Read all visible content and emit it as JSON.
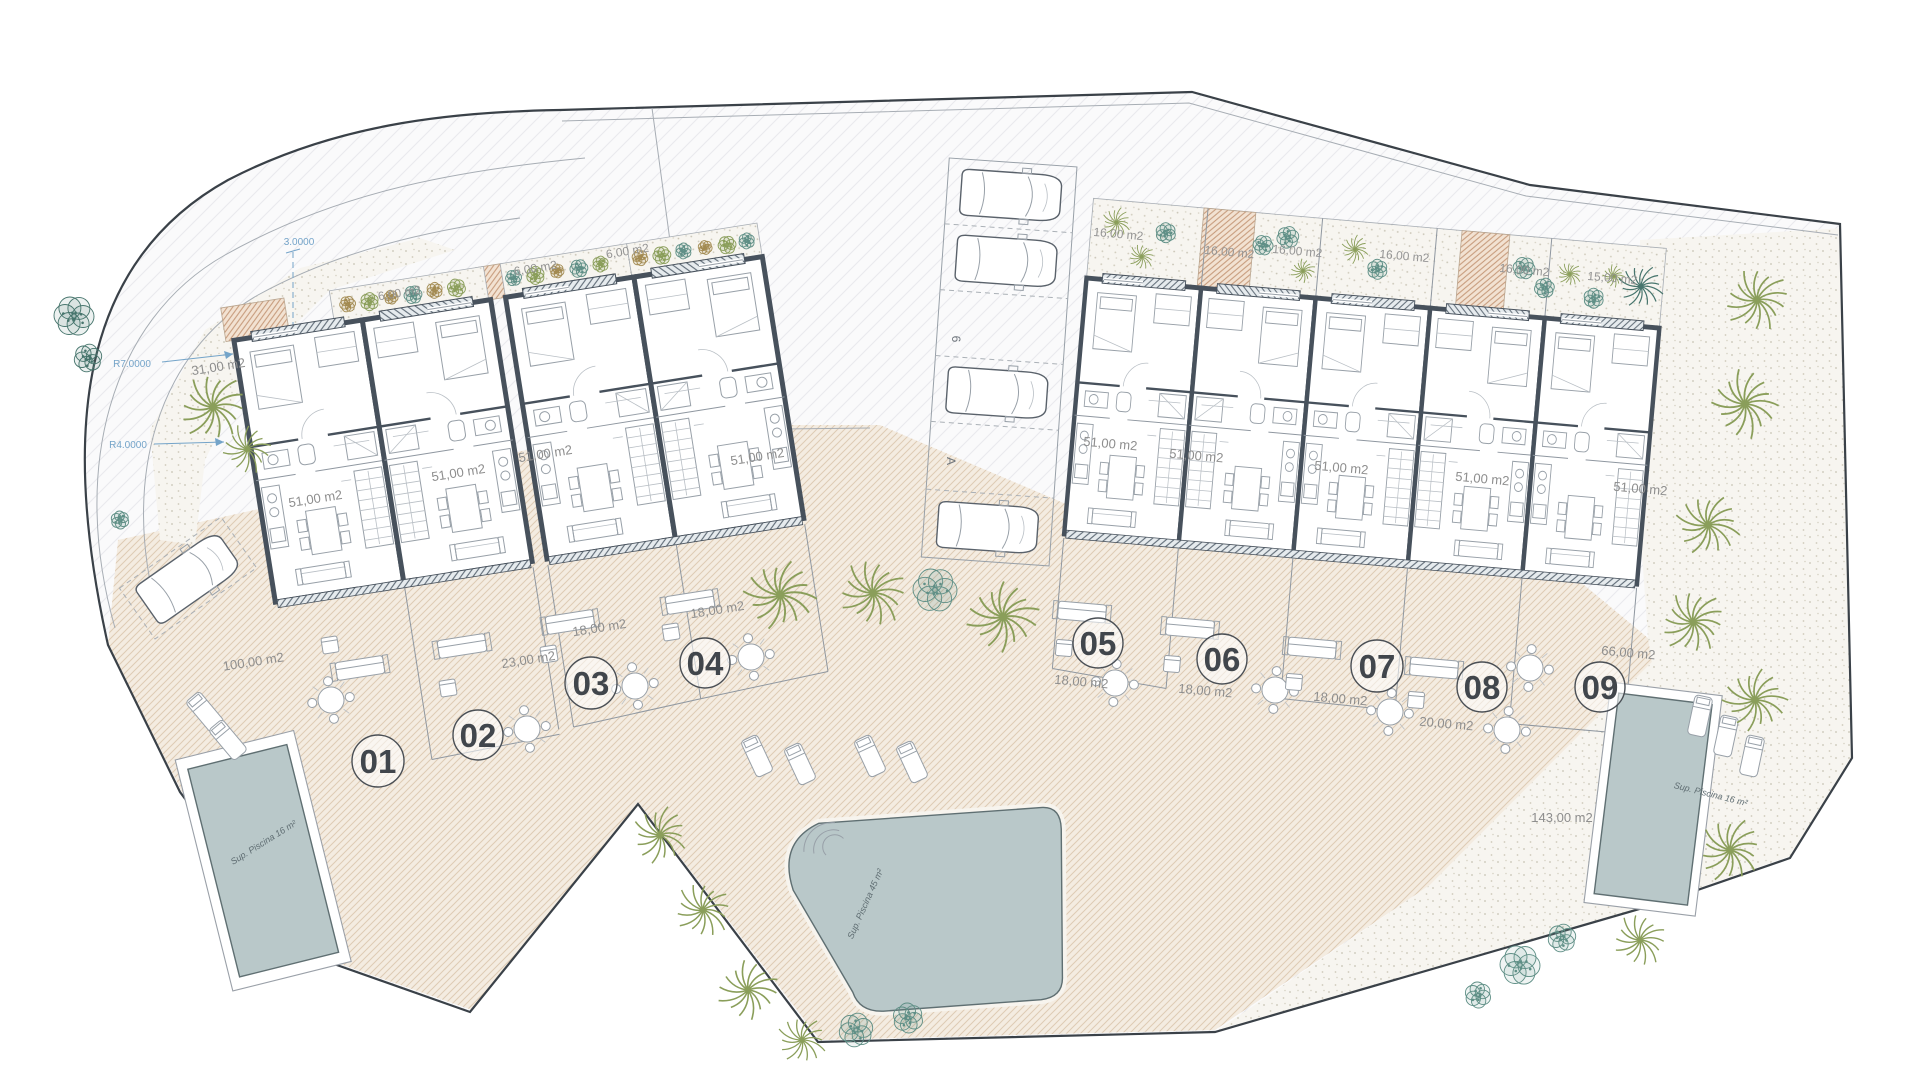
{
  "plan_type": "residential site plan, ground floor, 9 townhouse units",
  "annotations": {
    "dim_vertical": "3.0000",
    "radius_1": "R7.0000",
    "radius_2": "R4.0000"
  },
  "parking": {
    "stall_label_1": "6",
    "stall_label_2": "A"
  },
  "areas": {
    "left_garden": "31,00 m2",
    "planting_strips": [
      "6,00 m2",
      "6,00 m2",
      "6,00 m2"
    ],
    "front_gardens": [
      "16,00 m2",
      "16,00 m2",
      "16,00 m2",
      "16,00 m2",
      "16,00 m2",
      "15,00 m2"
    ],
    "right_terrace": "66,00 m2",
    "right_garden": "143,00 m2"
  },
  "units": [
    {
      "number": "01",
      "interior_area": "51,00 m2",
      "terrace_area": "100,00 m2"
    },
    {
      "number": "02",
      "interior_area": "51,00 m2",
      "terrace_area": "23,00 m2"
    },
    {
      "number": "03",
      "interior_area": "51,00 m2",
      "terrace_area": "18,00 m2"
    },
    {
      "number": "04",
      "interior_area": "51,00 m2",
      "terrace_area": "18,00 m2"
    },
    {
      "number": "05",
      "interior_area": "51,00 m2",
      "terrace_area": "18,00 m2"
    },
    {
      "number": "06",
      "interior_area": "51,00 m2",
      "terrace_area": "18,00 m2"
    },
    {
      "number": "07",
      "interior_area": "51,00 m2",
      "terrace_area": "18,00 m2"
    },
    {
      "number": "08",
      "interior_area": "51,00 m2",
      "terrace_area": "20,00 m2"
    },
    {
      "number": "09",
      "interior_area": "51,00 m2"
    }
  ],
  "pools": [
    {
      "label": "Sup. Piscina 16 m²"
    },
    {
      "label": "Sup. Piscina 45 m²"
    },
    {
      "label": "Sup. Piscina 16 m²"
    }
  ],
  "colors": {
    "wall": "#47515c",
    "terrace_hatch": "#decbb4",
    "entry_hatch": "#c59878",
    "pool_water": "#b9c8c9",
    "palm_olive": "#8a9e5a",
    "palm_teal": "#5f8f86",
    "shrub_brown": "#a38b52",
    "dimension_blue": "#74a4c9",
    "label_gray": "#8e8e8e"
  }
}
